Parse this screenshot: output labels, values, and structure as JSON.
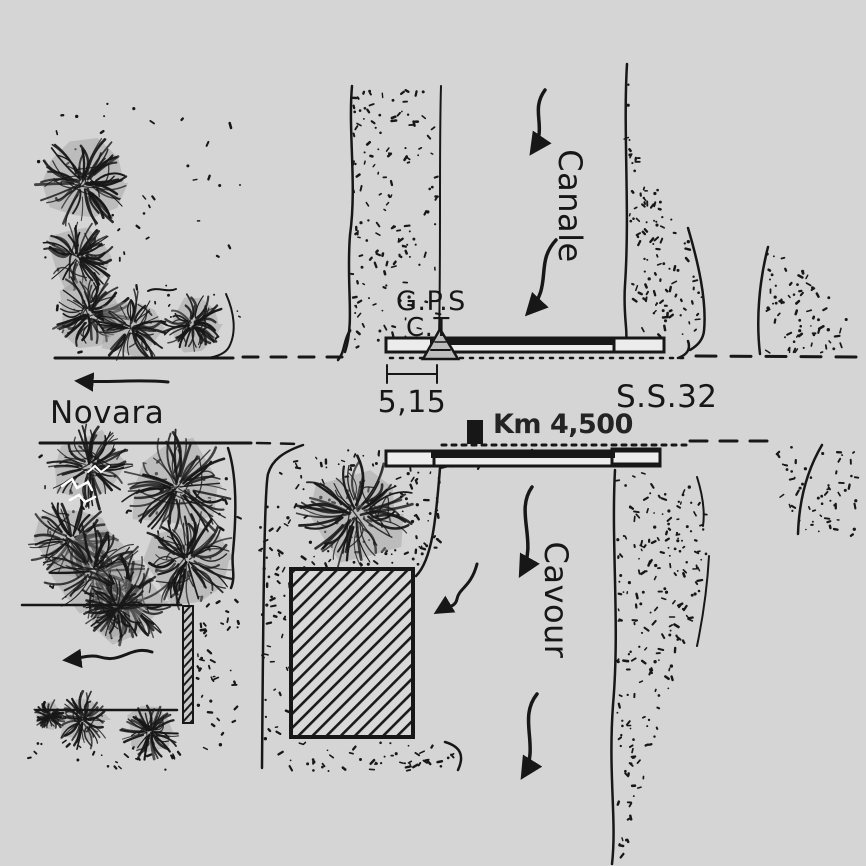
{
  "figure": {
    "kind": "hand-drawn site sketch of a GPS survey point at a canal-road crossing",
    "background_color": "#d5d5d6",
    "ink_color": "#171717"
  },
  "labels": {
    "station": "G.P.S",
    "station_sub": "C.T",
    "offset_dimension": "5,15",
    "road_name": "S.S.32",
    "road_direction": "Novara",
    "canal_name_top": "Canale",
    "canal_name_bottom": "Cavour",
    "km_marker": "Km 4,500"
  },
  "icons": {
    "station_marker": "triangle-survey-marker-icon",
    "km_stone": "km-stone-icon",
    "flow_arrow": "wavy-down-arrow-icon",
    "direction_arrow": "left-arrow-icon",
    "lane_arrow": "wavy-left-arrow-icon",
    "building_arrow": "wavy-left-arrow-icon"
  }
}
